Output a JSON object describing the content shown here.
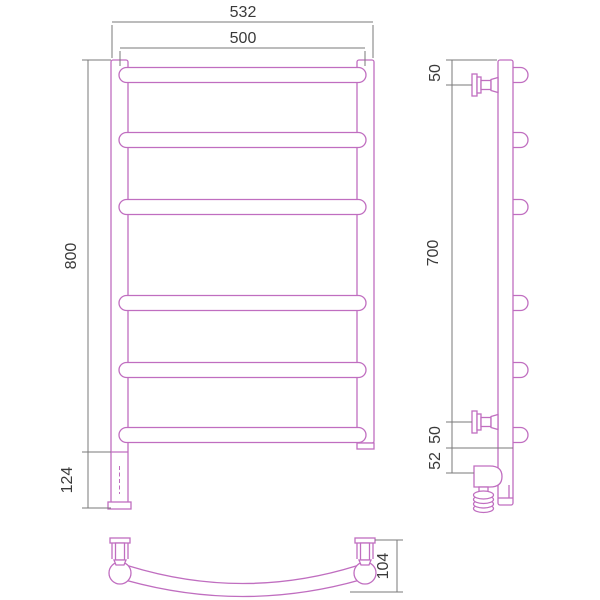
{
  "drawing": {
    "kind": "technical dimension drawing, ladder towel rail with electric cord, three orthographic views",
    "colors": {
      "part_outline": "#c06ec0",
      "dimension_lines": "#7a7a7a",
      "text": "#3a3a3a",
      "background": "#ffffff"
    },
    "views": {
      "front": {
        "rung_count": 6,
        "dims": {
          "overall_width": "532",
          "rung_width": "500",
          "height": "800",
          "leg": "124"
        }
      },
      "side": {
        "rung_count": 6,
        "dims": {
          "top_to_bracket": "50",
          "bracket_span": "700",
          "bracket_to_rung": "50",
          "rung_to_end": "52"
        }
      },
      "bottom": {
        "dims": {
          "depth": "104"
        }
      }
    }
  }
}
